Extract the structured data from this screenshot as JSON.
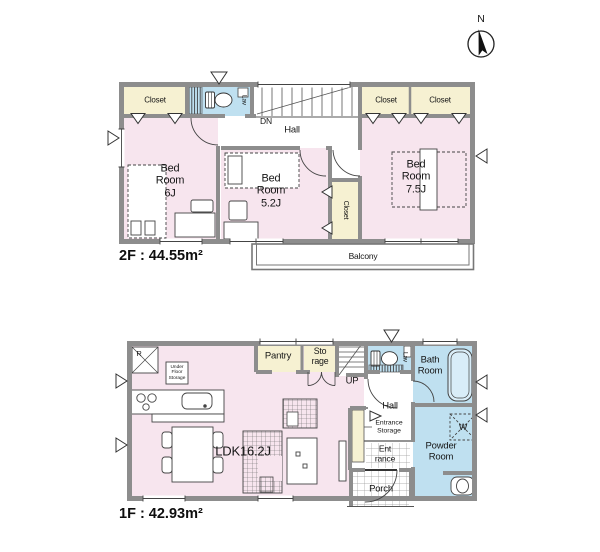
{
  "canvas": {
    "width": 600,
    "height": 552,
    "background": "#ffffff"
  },
  "palette": {
    "room_pink": "#f7e5ee",
    "closet_cream": "#f6f1d2",
    "wet_area_blue": "#bfe0f0",
    "bathtub_blue": "#d9edf8",
    "wall_gray": "#8d8d8d",
    "line_dark": "#3c3c3c"
  },
  "compass": {
    "north_label": "N"
  },
  "floor_2f": {
    "area_label": "2F : 44.55m²",
    "rooms": {
      "closet_left": "Closet",
      "lav": "Lav",
      "stairs_down": "DN",
      "hall": "Hall",
      "closet_right_1": "Closet",
      "closet_right_2": "Closet",
      "bedroom_6j": "Bed\nRoom\n6J",
      "bedroom_5_2j": "Bed\nRoom\n5.2J",
      "closet_middle": "Closet",
      "bedroom_7_5j": "Bed\nRoom\n7.5J",
      "balcony": "Balcony"
    }
  },
  "floor_1f": {
    "area_label": "1F : 42.93m²",
    "rooms": {
      "refrigerator": "R",
      "under_floor_storage": "Under\nFloor\nStorage",
      "pantry": "Pantry",
      "storage": "Sto\nrage",
      "stairs_up": "UP",
      "lav": "Lav",
      "bath_room": "Bath\nRoom",
      "hall": "Hall",
      "entrance_storage": "Entrance\nStorage",
      "ldk": "LDK16.2J",
      "entrance": "Ent\nrance",
      "porch": "Porch",
      "powder_room": "Powder\nRoom",
      "washing_machine": "W"
    }
  }
}
